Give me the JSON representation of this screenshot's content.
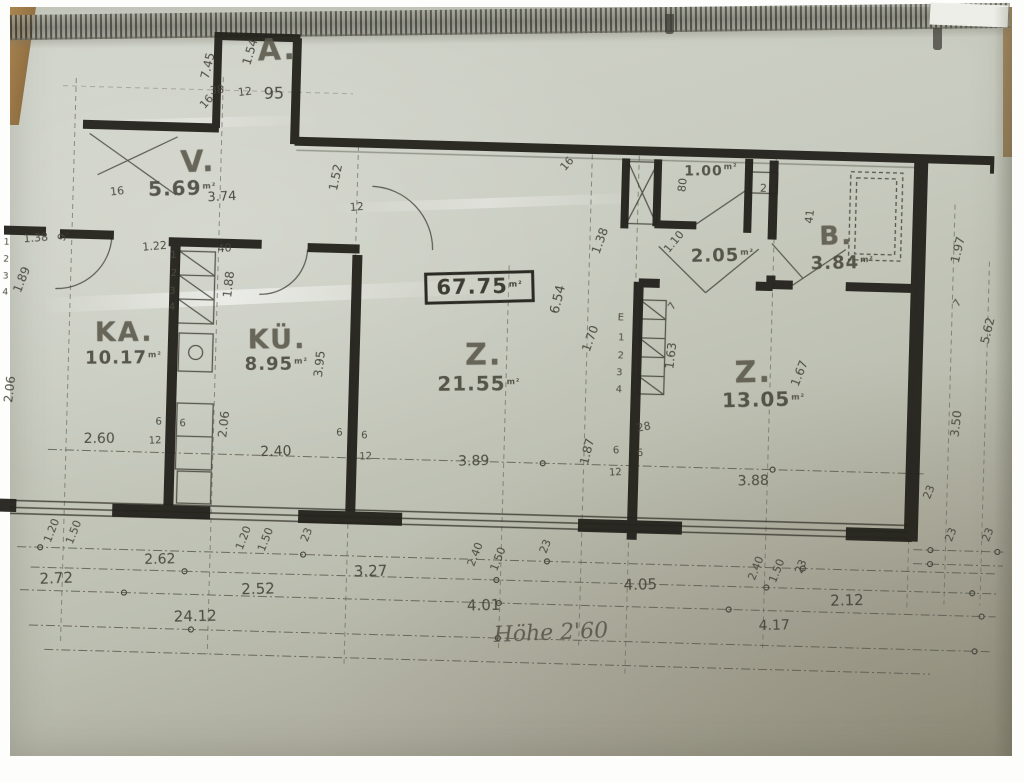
{
  "document": {
    "kind": "scanned floor plan photograph",
    "total_area": "67.75",
    "total_area_unit": "m²",
    "handwritten_note": "Höhe 2'60"
  },
  "rooms": [
    {
      "name": "A.",
      "area": "95"
    },
    {
      "name": "V.",
      "area": "5.69"
    },
    {
      "name": "KA.",
      "area": "10.17"
    },
    {
      "name": "KÜ.",
      "area": "8.95"
    },
    {
      "name": "Z.",
      "area": "21.55"
    },
    {
      "name": "Z.",
      "area": "13.05"
    },
    {
      "name": "B.",
      "area": "3.84"
    },
    {
      "name": "",
      "area": "2.05"
    },
    {
      "name": "",
      "area": "1.00"
    }
  ],
  "colors": {
    "paper": "#c8cbbf",
    "ink_walls": "#24231d",
    "ink_text": "#45443a",
    "stencil_text": "#595749",
    "binding_dark": "#32322c",
    "wood_edge": "#a98550"
  },
  "annotation_fields": [
    "text",
    "x",
    "y",
    "rotate_deg",
    "font_px",
    "kind",
    "unit"
  ],
  "annotations": [
    [
      "A.",
      268,
      57,
      -4,
      30,
      "room"
    ],
    [
      "V.",
      192,
      171,
      -4,
      30,
      "room"
    ],
    [
      "KA.",
      123,
      343,
      -2,
      27,
      "room"
    ],
    [
      "KÜ.",
      276,
      346,
      -2,
      27,
      "room"
    ],
    [
      "Z.",
      483,
      356,
      -2,
      30,
      "room"
    ],
    [
      "Z.",
      753,
      366,
      -3,
      30,
      "room"
    ],
    [
      "B.",
      832,
      227,
      -3,
      26,
      "room"
    ],
    [
      "95",
      266,
      100,
      -3,
      16,
      "dim"
    ],
    [
      "5.69",
      177,
      197,
      -3,
      20,
      "area",
      "m²"
    ],
    [
      "10.17",
      123,
      369,
      -2,
      18,
      "area",
      "m²"
    ],
    [
      "8.95",
      276,
      371,
      -2,
      18,
      "area",
      "m²"
    ],
    [
      "21.55",
      479,
      384,
      -2,
      20,
      "area",
      "m²"
    ],
    [
      "13.05",
      764,
      392,
      -3,
      20,
      "area",
      "m²"
    ],
    [
      "3.84",
      839,
      254,
      -3,
      18,
      "area",
      "m²"
    ],
    [
      "2.05",
      719,
      250,
      -3,
      18,
      "area",
      "m²"
    ],
    [
      "1.00",
      705,
      165,
      -2,
      14,
      "area",
      "m²"
    ],
    [
      "67.75",
      477,
      288,
      -3,
      21,
      "total",
      "m²"
    ],
    [
      "1.54",
      241,
      59,
      -75,
      12,
      "dim"
    ],
    [
      "7.45",
      199,
      74,
      -78,
      12,
      "dim"
    ],
    [
      "38",
      209,
      98,
      -8,
      11,
      "dim"
    ],
    [
      "12",
      237,
      99,
      -8,
      11,
      "dim"
    ],
    [
      "16",
      199,
      110,
      -50,
      11,
      "dim"
    ],
    [
      "3.74",
      217,
      205,
      -4,
      13,
      "dim"
    ],
    [
      "16",
      112,
      202,
      -8,
      11,
      "dim"
    ],
    [
      "1.52",
      330,
      182,
      -80,
      12,
      "dim"
    ],
    [
      "12",
      352,
      211,
      -6,
      11,
      "dim"
    ],
    [
      "16",
      561,
      162,
      -50,
      11,
      "dim"
    ],
    [
      "1.38",
      32,
      251,
      -6,
      11,
      "dim"
    ],
    [
      "9.",
      59,
      248,
      -65,
      11,
      "dim"
    ],
    [
      "1.89",
      19,
      293,
      -70,
      12,
      "dim"
    ],
    [
      "2.06",
      10,
      403,
      -85,
      12,
      "dim"
    ],
    [
      "1.22",
      151,
      256,
      -6,
      11,
      "dim"
    ],
    [
      "40",
      221,
      256,
      -6,
      11,
      "dim"
    ],
    [
      "1.88",
      226,
      292,
      -85,
      12,
      "dim"
    ],
    [
      "3.95",
      319,
      369,
      -85,
      12,
      "dim"
    ],
    [
      "2.06",
      225,
      432,
      -85,
      12,
      "dim"
    ],
    [
      "1.38",
      596,
      238,
      -72,
      12,
      "dim"
    ],
    [
      "6.54",
      556,
      298,
      -78,
      13,
      "dim"
    ],
    [
      "1.70",
      589,
      336,
      -72,
      12,
      "dim"
    ],
    [
      "1.63",
      670,
      351,
      -85,
      12,
      "dim"
    ],
    [
      "7",
      671,
      302,
      -55,
      10,
      "dim"
    ],
    [
      "28",
      645,
      423,
      -12,
      11,
      "dim"
    ],
    [
      "1.87",
      589,
      449,
      -78,
      12,
      "dim"
    ],
    [
      "1.10",
      670,
      237,
      -52,
      11,
      "dim"
    ],
    [
      "80",
      677,
      180,
      -85,
      11,
      "dim"
    ],
    [
      "41",
      805,
      208,
      -85,
      11,
      "dim"
    ],
    [
      "1.97",
      954,
      237,
      -78,
      12,
      "dim"
    ],
    [
      "7",
      956,
      291,
      -55,
      10,
      "dim"
    ],
    [
      "5.62",
      986,
      317,
      -78,
      12,
      "dim"
    ],
    [
      "3.50",
      957,
      411,
      -85,
      12,
      "dim"
    ],
    [
      "1.67",
      799,
      365,
      -70,
      12,
      "dim"
    ],
    [
      "2",
      758,
      181,
      0,
      11,
      "dim"
    ],
    [
      "2.60",
      101,
      450,
      -2,
      14,
      "dim"
    ],
    [
      "6",
      160,
      432,
      -4,
      10,
      "dim"
    ],
    [
      "6",
      184,
      433,
      -4,
      10,
      "dim"
    ],
    [
      "12",
      157,
      451,
      -4,
      10,
      "dim"
    ],
    [
      "2.40",
      278,
      458,
      -3,
      14,
      "dim"
    ],
    [
      "6",
      341,
      438,
      -4,
      10,
      "dim"
    ],
    [
      "6",
      366,
      440,
      -4,
      10,
      "dim"
    ],
    [
      "12",
      368,
      461,
      -4,
      10,
      "dim"
    ],
    [
      "3.89",
      476,
      462,
      -3,
      14,
      "dim"
    ],
    [
      "6",
      618,
      448,
      -4,
      10,
      "dim"
    ],
    [
      "6",
      642,
      450,
      -4,
      10,
      "dim"
    ],
    [
      "12",
      618,
      470,
      -4,
      10,
      "dim"
    ],
    [
      "3.88",
      756,
      474,
      -3,
      14,
      "dim"
    ],
    [
      "23",
      932,
      480,
      -70,
      11,
      "dim"
    ],
    [
      "1.20",
      56,
      543,
      -70,
      11,
      "dim"
    ],
    [
      "1.50",
      78,
      544,
      -70,
      11,
      "dim"
    ],
    [
      "1.20",
      248,
      545,
      -70,
      11,
      "dim"
    ],
    [
      "1.50",
      270,
      546,
      -70,
      11,
      "dim"
    ],
    [
      "23",
      311,
      540,
      -70,
      11,
      "dim"
    ],
    [
      "2.40",
      480,
      555,
      -70,
      11,
      "dim"
    ],
    [
      "1.50",
      503,
      559,
      -70,
      11,
      "dim"
    ],
    [
      "23",
      550,
      545,
      -70,
      11,
      "dim"
    ],
    [
      "2.40",
      761,
      561,
      -70,
      11,
      "dim"
    ],
    [
      "1.50",
      782,
      563,
      -70,
      11,
      "dim"
    ],
    [
      "23",
      806,
      558,
      -70,
      11,
      "dim"
    ],
    [
      "23",
      955,
      522,
      -70,
      11,
      "dim"
    ],
    [
      "23",
      992,
      521,
      -70,
      11,
      "dim"
    ],
    [
      "2.62",
      165,
      569,
      -3,
      14,
      "dim"
    ],
    [
      "2.72",
      62,
      591,
      -4,
      15,
      "dim"
    ],
    [
      "2.52",
      264,
      596,
      -3,
      15,
      "dim"
    ],
    [
      "3.27",
      376,
      575,
      -3,
      15,
      "dim"
    ],
    [
      "4.01",
      490,
      606,
      -3,
      15,
      "dim"
    ],
    [
      "4.05",
      646,
      581,
      -3,
      15,
      "dim"
    ],
    [
      "2.12",
      853,
      591,
      -3,
      15,
      "dim"
    ],
    [
      "4.17",
      781,
      618,
      -3,
      14,
      "dim"
    ],
    [
      "24.12",
      202,
      625,
      -3,
      15,
      "dim"
    ],
    [
      "E",
      619,
      315,
      0,
      10,
      "step"
    ],
    [
      "1",
      620,
      335,
      0,
      10,
      "step"
    ],
    [
      "2",
      620,
      353,
      0,
      10,
      "step"
    ],
    [
      "3",
      619,
      370,
      0,
      10,
      "step"
    ],
    [
      "4",
      619,
      387,
      0,
      10,
      "step"
    ],
    [
      "1",
      170,
      265,
      0,
      10,
      "step"
    ],
    [
      "2",
      171,
      283,
      0,
      10,
      "step"
    ],
    [
      "3",
      170,
      301,
      0,
      10,
      "step"
    ],
    [
      "4",
      170,
      317,
      0,
      10,
      "step"
    ],
    [
      "1",
      3,
      257,
      0,
      9,
      "step"
    ],
    [
      "2",
      3,
      274,
      0,
      9,
      "step"
    ],
    [
      "3",
      3,
      291,
      0,
      9,
      "step"
    ],
    [
      "4",
      3,
      307,
      0,
      9,
      "step"
    ],
    [
      "Höhe 2'60",
      558,
      632,
      -4,
      22,
      "hand"
    ]
  ]
}
